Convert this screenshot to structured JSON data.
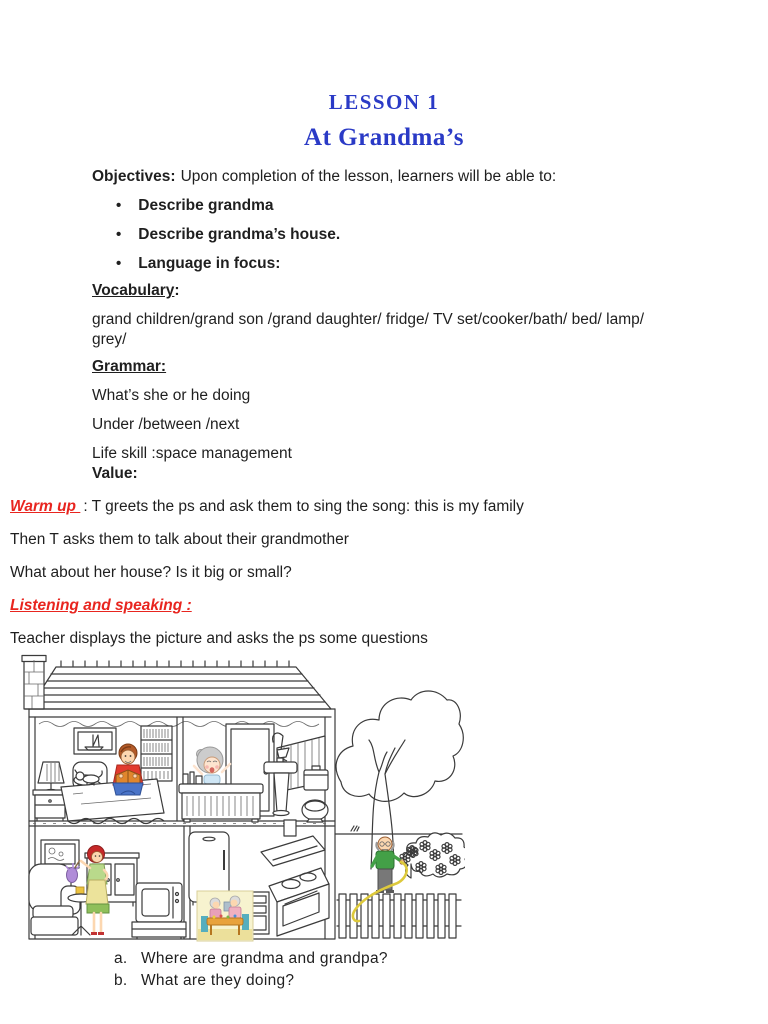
{
  "header": {
    "lesson": "LESSON 1",
    "title": "At Grandma’s"
  },
  "objectives": {
    "label": "Objectives:",
    "intro": "Upon completion of the lesson, learners will be able to:",
    "bullet_char": "•",
    "bullets": [
      "Describe grandma",
      "Describe grandma’s house.",
      "Language in focus:"
    ]
  },
  "vocabulary": {
    "label": "Vocabulary",
    "colon": ":",
    "line1": "grand children/grand son /grand daughter/ fridge/ TV set/cooker/bath/ bed/ lamp/",
    "line2": "grey/"
  },
  "grammar": {
    "label": "Grammar:",
    "lines": [
      "What’s she or he doing",
      "Under /between /next",
      "Life skill :space management"
    ]
  },
  "value_label": "Value:",
  "warm_up": {
    "label": "Warm up ",
    "rest": ": T greets the ps and ask them to sing the song: this is my family",
    "line2": "Then T asks them to talk about their grandmother",
    "line3": "What about her house? Is it big or small?"
  },
  "listening": {
    "label": "Listening and speaking :",
    "intro": "Teacher displays the picture and asks the ps some questions"
  },
  "questions": [
    {
      "marker": "a.",
      "text": "Where are grandma and grandpa?"
    },
    {
      "marker": "b.",
      "text": "What are they doing?"
    }
  ],
  "illustration": {
    "alt": "Cutaway line drawing of grandma’s two-storey house: boy reading on a bed in the bedroom, grandma in the bath, woman dusting in the living room, kitchen with fridge and cooker, grandpa watering garden flowers by a tree and picket fence"
  },
  "colors": {
    "title_blue": "#2a3ac6",
    "heading_red": "#e8251f"
  }
}
